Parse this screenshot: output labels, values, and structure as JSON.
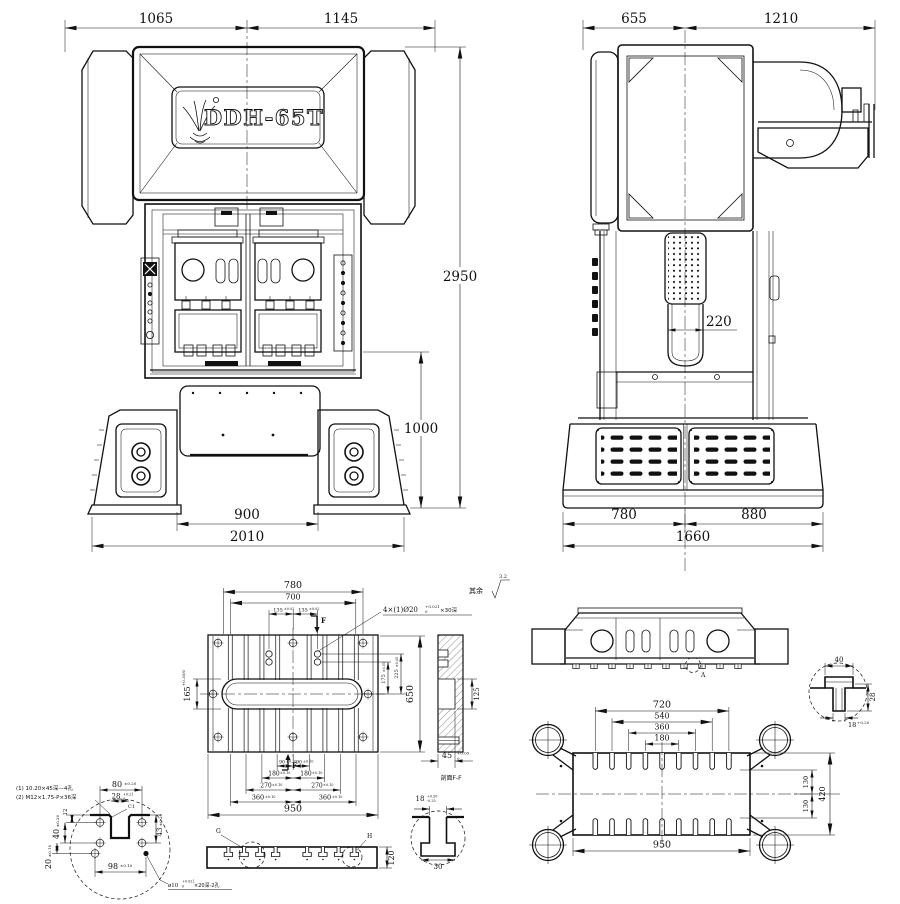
{
  "front_view": {
    "logo_text": "DDH-65T",
    "dims": {
      "top_left": "1065",
      "top_right": "1145",
      "overall_height": "2950",
      "work_height": "1000",
      "base_inner": "900",
      "base_outer": "2010"
    }
  },
  "side_view": {
    "dims": {
      "top_left": "655",
      "top_right": "1210",
      "column_width": "220",
      "base_left": "780",
      "base_right": "880",
      "base_total": "1660"
    }
  },
  "bolster_plan": {
    "surface_note": "其余",
    "surface_roughness": "3.2",
    "section_mark_top": "F",
    "section_mark_bottom": "F",
    "hole_note": {
      "prefix": "4×(1)Ø20",
      "tol_up": "+0.021",
      "tol_dn": "0",
      "suffix": "×30深"
    },
    "dims": {
      "w780": "780",
      "w700": "700",
      "l135": {
        "v": "135",
        "tol": "±0.02"
      },
      "r135": {
        "v": "135",
        "tol": "±0.02"
      },
      "h165": {
        "v": "165",
        "tol": "+0.30/0"
      },
      "h175": {
        "v": "175",
        "tol": "±0.05"
      },
      "h225": {
        "v": "225",
        "tol": "±0.05"
      },
      "h650": "650",
      "b90l": {
        "v": "90",
        "tol": "±0.10"
      },
      "b90r": {
        "v": "90",
        "tol": "±0.10"
      },
      "b180l": {
        "v": "180",
        "tol": "±0.10"
      },
      "b180r": {
        "v": "180",
        "tol": "±0.10"
      },
      "b270l": {
        "v": "270",
        "tol": "±0.10"
      },
      "b270r": {
        "v": "270",
        "tol": "±0.10"
      },
      "b360l": {
        "v": "360",
        "tol": "±0.10"
      },
      "b360r": {
        "v": "360",
        "tol": "±0.10"
      },
      "w950": "950"
    }
  },
  "section_ff": {
    "caption": "剖面F-F",
    "dims": {
      "d125": "125",
      "d45": {
        "v": "45",
        "tol_up": "+0.05",
        "tol_dn": "0"
      }
    }
  },
  "corner_detail": {
    "note1": "(1) 10.20×45深—4孔",
    "note2": "(2) M12×1.75-P×36深",
    "chamfer": "C1",
    "hole_note": {
      "prefix": "ø10",
      "tol_up": "+0.021",
      "tol_dn": "0",
      "suffix": "×20深-2孔"
    },
    "dims": {
      "d80": {
        "v": "80",
        "tol": "±0.20"
      },
      "d28": {
        "v": "28",
        "tol_up": "+0.21",
        "tol_dn": "0"
      },
      "d12": "12",
      "d43": {
        "v": "43",
        "tol": "±0.20"
      },
      "d40": {
        "v": "40",
        "tol": "±0.20"
      },
      "d20": {
        "v": "20",
        "tol": "±0.10"
      },
      "d98": {
        "v": "98",
        "tol": "±0.10"
      }
    }
  },
  "bolster_profile": {
    "detail_g": "G",
    "detail_h": "H",
    "dims": {
      "h120": "120"
    },
    "slot_detail": {
      "d18": {
        "v": "18",
        "tol_up": "+0.50",
        "tol_dn": "-0.25"
      },
      "d30": "30"
    }
  },
  "slide_view": {
    "dims": {
      "w720": "720",
      "w540": "540",
      "w360": "360",
      "w180": "180",
      "w950": "950",
      "h130a": "130",
      "h130b": "130",
      "h420": "420"
    },
    "detail": {
      "d40": "40",
      "d28": "28",
      "d18": {
        "v": "18",
        "tol": "+0.20"
      }
    }
  },
  "bolster_elevation": {
    "detail_a": "A"
  }
}
